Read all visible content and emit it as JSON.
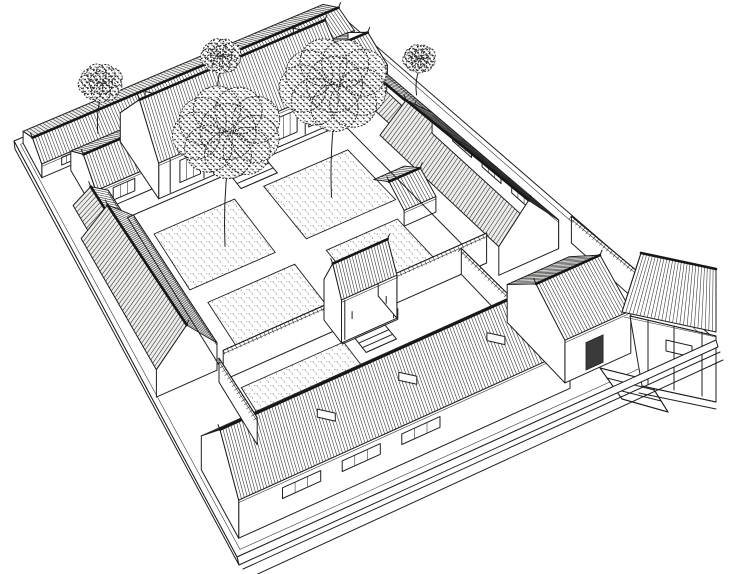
{
  "figure": {
    "kind": "hand-drawn architectural line illustration",
    "projection": "bird's-eye axonometric",
    "subject": "siheyuan courtyard residence",
    "visible_text": ""
  },
  "palette": {
    "ink": "#1f1f1f",
    "paper": "#ffffff",
    "shade": "#ececea",
    "stipple": "#4a4a4a"
  },
  "scene": {
    "corners": {
      "W": [
        14,
        141
      ],
      "N": [
        331,
        7
      ],
      "E": [
        716,
        340
      ],
      "S": [
        237,
        557
      ]
    },
    "hscale": [
      0.45,
      0.85
    ],
    "elements": [
      {
        "t": "slab",
        "name": "base-platform"
      },
      {
        "t": "bld",
        "name": "rear-range",
        "axis": "u",
        "u": [
          0.02,
          0.96
        ],
        "v": [
          0.012,
          0.095
        ],
        "hw": 26,
        "hr": 46,
        "gable": "start",
        "win": {
          "n": 6,
          "a": [
            0.05,
            0.5
          ],
          "h": [
            0.3,
            0.85
          ]
        },
        "vents": [
          0.38,
          0.62,
          0.86
        ]
      },
      {
        "t": "bld",
        "name": "west-ear-room",
        "axis": "u",
        "u": [
          0.1,
          0.26
        ],
        "v": [
          0.105,
          0.21
        ],
        "hw": 36,
        "hr": 64,
        "gable": "start",
        "win": {
          "n": 1,
          "a": [
            0.2,
            0.8
          ],
          "h": [
            0.25,
            0.8
          ]
        }
      },
      {
        "t": "bld",
        "name": "east-ear-room",
        "axis": "u",
        "u": [
          0.8,
          0.93
        ],
        "v": [
          0.105,
          0.21
        ],
        "hw": 36,
        "hr": 64,
        "gable": "end",
        "win": {
          "n": 1,
          "a": [
            0.2,
            0.8
          ],
          "h": [
            0.25,
            0.8
          ]
        }
      },
      {
        "t": "bld",
        "name": "north-hall",
        "axis": "u",
        "u": [
          0.26,
          0.8
        ],
        "v": [
          0.09,
          0.235
        ],
        "hw": 55,
        "hr": 120,
        "gable": "start",
        "cols": 6,
        "win": {
          "n": 5,
          "a": [
            0.08,
            0.92
          ],
          "h": [
            0.2,
            0.82
          ]
        }
      },
      {
        "t": "tree",
        "name": "tree-small-west",
        "u": 0.22,
        "v": 0.055,
        "r": 23,
        "lift": 38
      },
      {
        "t": "tree",
        "name": "tree-rear-court",
        "u": 0.56,
        "v": 0.085,
        "r": 21,
        "lift": 30
      },
      {
        "t": "tree",
        "name": "tree-northeast",
        "u": 0.97,
        "v": 0.25,
        "r": 17,
        "lift": 27
      },
      {
        "t": "bld",
        "name": "northwest-walkway",
        "axis": "v",
        "u": [
          0.035,
          0.135
        ],
        "v": [
          0.21,
          0.285
        ],
        "hw": 28,
        "hr": 46,
        "cols": 3
      },
      {
        "t": "bld",
        "name": "northeast-walkway",
        "axis": "v",
        "u": [
          0.82,
          0.92
        ],
        "v": [
          0.21,
          0.34
        ],
        "hw": 28,
        "hr": 46,
        "cols": 3
      },
      {
        "t": "bld",
        "name": "west-wing",
        "axis": "v",
        "u": [
          0.01,
          0.155
        ],
        "v": [
          0.285,
          0.62
        ],
        "hw": 28,
        "hr": 60,
        "gable": "end",
        "cols": 5,
        "win": {
          "n": 4,
          "a": [
            0.08,
            0.9
          ],
          "h": [
            0.22,
            0.8
          ]
        }
      },
      {
        "t": "bld",
        "name": "east-wing",
        "axis": "v",
        "u": [
          0.78,
          0.92
        ],
        "v": [
          0.34,
          0.68
        ],
        "hw": 28,
        "hr": 60,
        "gable": "end",
        "win": {
          "n": 3,
          "a": [
            0.12,
            0.82
          ],
          "h": [
            0.5,
            0.8
          ]
        }
      },
      {
        "t": "bld",
        "name": "east-stub-room",
        "axis": "u",
        "u": [
          0.7,
          0.78
        ],
        "v": [
          0.41,
          0.5
        ],
        "hw": 18,
        "hr": 34
      },
      {
        "t": "court",
        "name": "main-courtyard",
        "outline": {
          "u": [
            0.165,
            0.77
          ],
          "v": [
            0.245,
            0.635
          ]
        },
        "beds": [
          {
            "name": "planting-bed-northwest",
            "u": [
              0.2,
              0.42
            ],
            "v": [
              0.3,
              0.44
            ]
          },
          {
            "name": "planting-bed-northeast",
            "u": [
              0.5,
              0.73
            ],
            "v": [
              0.3,
              0.44
            ]
          },
          {
            "name": "planting-bed-southwest",
            "u": [
              0.22,
              0.44
            ],
            "v": [
              0.48,
              0.6
            ]
          },
          {
            "name": "planting-bed-southeast",
            "u": [
              0.52,
              0.7
            ],
            "v": [
              0.48,
              0.6
            ]
          }
        ],
        "steps": {
          "u": [
            0.45,
            0.55
          ],
          "v": [
            0.245,
            0.285
          ],
          "n": 3
        }
      },
      {
        "t": "tree",
        "name": "courtyard-tree-west",
        "u": 0.33,
        "v": 0.385,
        "r": 56,
        "lift": 84
      },
      {
        "t": "tree",
        "name": "courtyard-tree-east",
        "u": 0.615,
        "v": 0.38,
        "r": 56,
        "lift": 82
      },
      {
        "t": "wall",
        "name": "divider-wall-west",
        "a": [
          0.155,
          0.645
        ],
        "b": [
          0.415,
          0.645
        ],
        "h": 30
      },
      {
        "t": "wall",
        "name": "divider-wall-east",
        "a": [
          0.545,
          0.645
        ],
        "b": [
          0.78,
          0.645
        ],
        "h": 30
      },
      {
        "t": "gate2",
        "name": "inner-gate",
        "plat": {
          "u": [
            0.415,
            0.545
          ],
          "v": [
            0.612,
            0.678
          ],
          "h": 10
        },
        "roof": {
          "axis": "u",
          "u": [
            0.415,
            0.545
          ],
          "v": [
            0.615,
            0.675
          ],
          "hw": 42,
          "hr": 68,
          "gable": "both",
          "cols": 2
        },
        "steps": {
          "u": [
            0.445,
            0.515
          ],
          "v": [
            0.678,
            0.715
          ],
          "n": 3
        }
      },
      {
        "t": "bed",
        "name": "front-court-bed",
        "u": [
          0.18,
          0.42
        ],
        "v": [
          0.675,
          0.775
        ]
      },
      {
        "t": "wall",
        "name": "passage-wall",
        "a": [
          0.72,
          0.645
        ],
        "b": [
          0.72,
          0.8
        ],
        "h": 26
      },
      {
        "t": "wall",
        "name": "entrance-court-wall",
        "a": [
          0.95,
          0.68
        ],
        "b": [
          0.95,
          0.88
        ],
        "h": 26
      },
      {
        "t": "bld",
        "name": "south-range",
        "axis": "u",
        "u": [
          0.02,
          0.72
        ],
        "v": [
          0.8,
          0.965
        ],
        "hw": 30,
        "hr": 62,
        "gable": "start",
        "win": {
          "n": 3,
          "a": [
            0.1,
            0.64
          ],
          "h": [
            0.52,
            0.8
          ]
        },
        "vents": [
          0.3,
          0.55,
          0.82
        ]
      },
      {
        "t": "wall",
        "name": "southwest-court-wall",
        "a": [
          0.145,
          0.645
        ],
        "b": [
          0.145,
          0.8
        ],
        "h": 24
      },
      {
        "t": "bld",
        "name": "entrance-gate-hall",
        "axis": "u",
        "u": [
          0.72,
          0.86
        ],
        "v": [
          0.78,
          0.95
        ],
        "hw": 34,
        "hr": 58,
        "gable": "start",
        "door": true
      },
      {
        "t": "stepsSE",
        "name": "entrance-steps",
        "underlay": [
          [
            600,
            368
          ],
          [
            648,
            380
          ],
          [
            668,
            412
          ],
          [
            622,
            399
          ]
        ],
        "treads": [
          [
            [
              600,
              368
            ],
            [
              648,
              380
            ]
          ],
          [
            [
              607,
              378
            ],
            [
              654,
              390
            ]
          ],
          [
            [
              614,
              389
            ],
            [
              661,
              401
            ]
          ],
          [
            [
              622,
              399
            ],
            [
              668,
              412
            ]
          ]
        ],
        "rails": [
          [
            [
              600,
              368
            ],
            [
              622,
              399
            ]
          ],
          [
            [
              648,
              380
            ],
            [
              668,
              412
            ]
          ]
        ]
      },
      {
        "t": "porch",
        "name": "gatehouse-veranda",
        "wall": [
          [
            630,
            316
          ],
          [
            716,
            336
          ],
          [
            716,
            402
          ],
          [
            642,
            386
          ]
        ],
        "window": [
          [
            666,
            340
          ],
          [
            692,
            346
          ],
          [
            692,
            357
          ],
          [
            666,
            351
          ]
        ],
        "slope": [
          [
            641,
            253
          ],
          [
            716,
            269
          ],
          [
            716,
            332
          ],
          [
            622,
            312
          ]
        ],
        "eave2": [
          [
            624,
            317
          ],
          [
            716,
            337
          ]
        ],
        "beam": [
          [
            630,
            316
          ],
          [
            716,
            336
          ]
        ],
        "posts": [
          [
            [
              648,
              320
            ],
            [
              648,
              384
            ]
          ],
          [
            [
              674,
              326
            ],
            [
              674,
              390
            ]
          ],
          [
            [
              702,
              332
            ],
            [
              702,
              396
            ]
          ]
        ],
        "base": [
          [
            [
              642,
              386
            ],
            [
              716,
              402
            ]
          ],
          [
            [
              639,
              393
            ],
            [
              716,
              409
            ]
          ]
        ],
        "gableEdge": [
          [
            641,
            253
          ],
          [
            622,
            312
          ]
        ]
      },
      {
        "t": "curb",
        "name": "street-edge",
        "sideSE": [
          [
            237,
            557
          ],
          [
            716,
            340
          ],
          [
            718,
            347
          ],
          [
            239,
            565
          ]
        ],
        "sideSW": [
          [
            14,
            141
          ],
          [
            237,
            557
          ],
          [
            239,
            565
          ],
          [
            15,
            149
          ]
        ],
        "lines": [
          [
            [
              243,
              569
            ],
            [
              720,
              352
            ]
          ],
          [
            [
              249,
              578
            ],
            [
              723,
              360
            ]
          ]
        ]
      }
    ]
  }
}
